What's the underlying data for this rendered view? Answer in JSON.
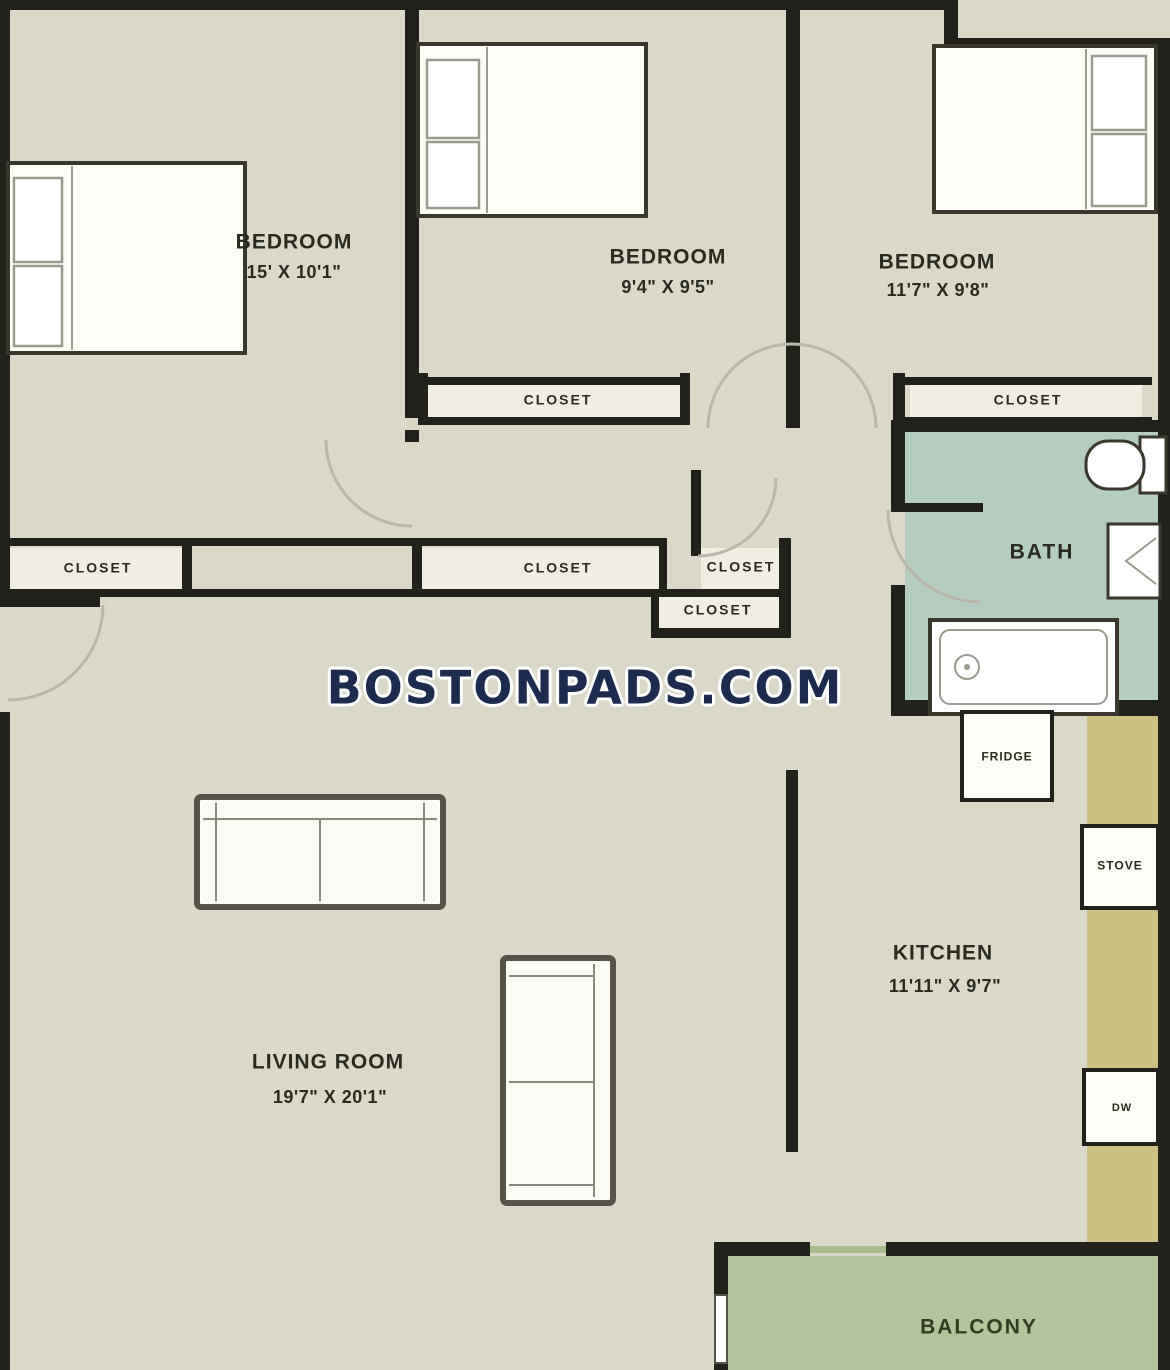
{
  "watermark": {
    "text": "BOSTONPADS.COM"
  },
  "rooms": {
    "bedroom1": {
      "name": "BEDROOM",
      "dims": "15' X 10'1\""
    },
    "bedroom2": {
      "name": "BEDROOM",
      "dims": "9'4\" X 9'5\""
    },
    "bedroom3": {
      "name": "BEDROOM",
      "dims": "11'7\" X 9'8\""
    },
    "kitchen": {
      "name": "KITCHEN",
      "dims": "11'11\" X 9'7\""
    },
    "living": {
      "name": "LIVING ROOM",
      "dims": "19'7\" X 20'1\""
    },
    "bath": {
      "name": "BATH"
    },
    "balcony": {
      "name": "BALCONY"
    }
  },
  "closets": {
    "bedroom2_closet": "CLOSET",
    "bedroom3_closet": "CLOSET",
    "hall_left": "CLOSET",
    "hall_long": "CLOSET",
    "hall_small": "CLOSET",
    "hall_lower": "CLOSET"
  },
  "appliances": {
    "fridge": "FRIDGE",
    "stove": "STOVE",
    "dishwasher": "DW"
  },
  "colors": {
    "floor": "#dad8c9",
    "wall": "#23211b",
    "bath_floor": "#b5ccc1",
    "balcony_floor": "#b4c49d",
    "balcony_sill": "#a8bd8b",
    "counter": "#cdc083",
    "closet_interior": "#f0eee3",
    "door_arc": "#b9b7ab",
    "watermark_text": "#1d2c4e",
    "balcony_text": "#333c22",
    "label_text": "#2b2a21"
  }
}
